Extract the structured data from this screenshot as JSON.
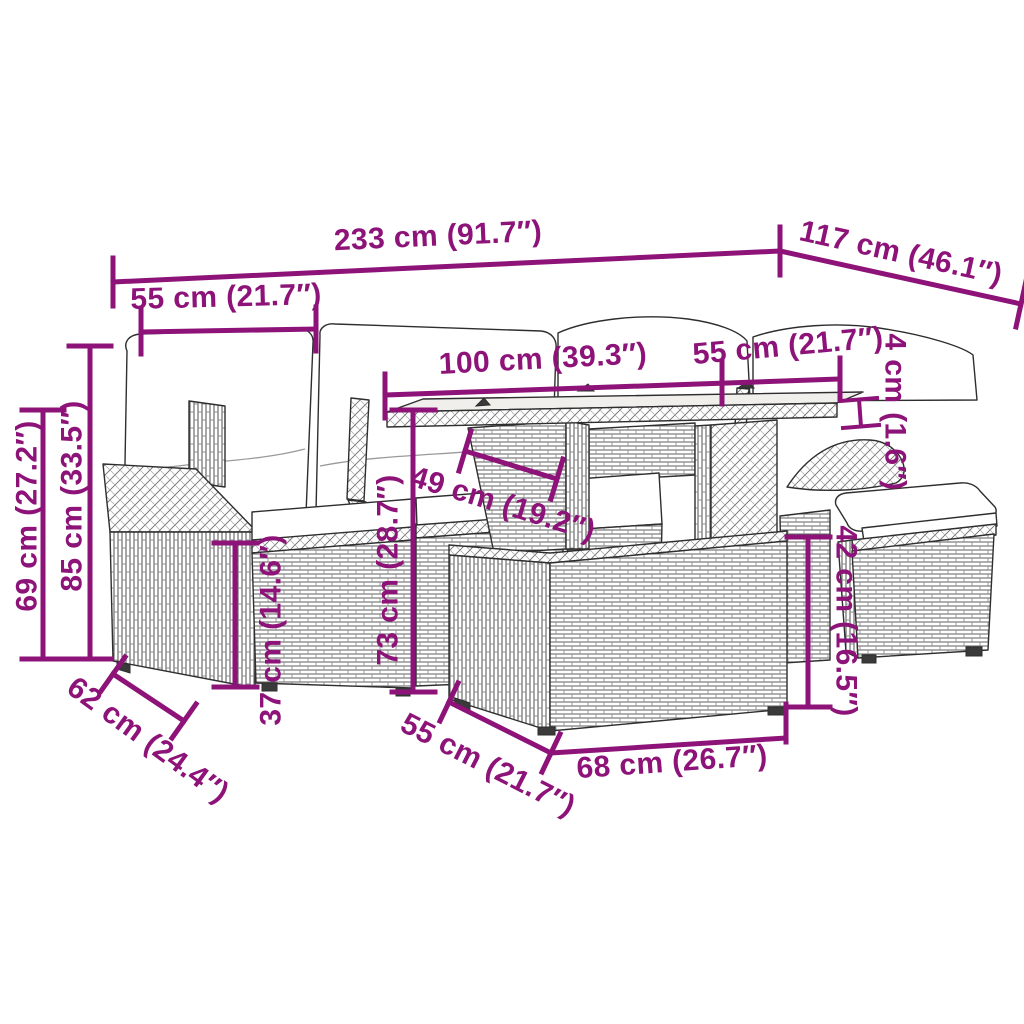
{
  "style": {
    "accent_color": "#8D1379",
    "artwork_line_color": "#2e2e2e",
    "background_color": "#ffffff"
  },
  "dims": {
    "total_width": "233 cm (91.7″)",
    "total_depth": "117 cm (46.1″)",
    "left_module_width": "55 cm (21.7″)",
    "table_length": "100 cm (39.3″)",
    "right_module_width": "55 cm (21.7″)",
    "tabletop_thickness": "4 cm (1.6″)",
    "armrest_height": "69 cm (27.2″)",
    "backrest_height": "85 cm (33.5″)",
    "module_depth": "62 cm (24.4″)",
    "seat_height": "37 cm (14.6″)",
    "table_height": "73 cm (28.7″)",
    "tabletop_depth": "49 cm (19.2″)",
    "ottoman_depth": "55 cm (21.7″)",
    "ottoman_width": "68 cm (26.7″)",
    "ottoman_height": "42 cm (16.5″)"
  }
}
